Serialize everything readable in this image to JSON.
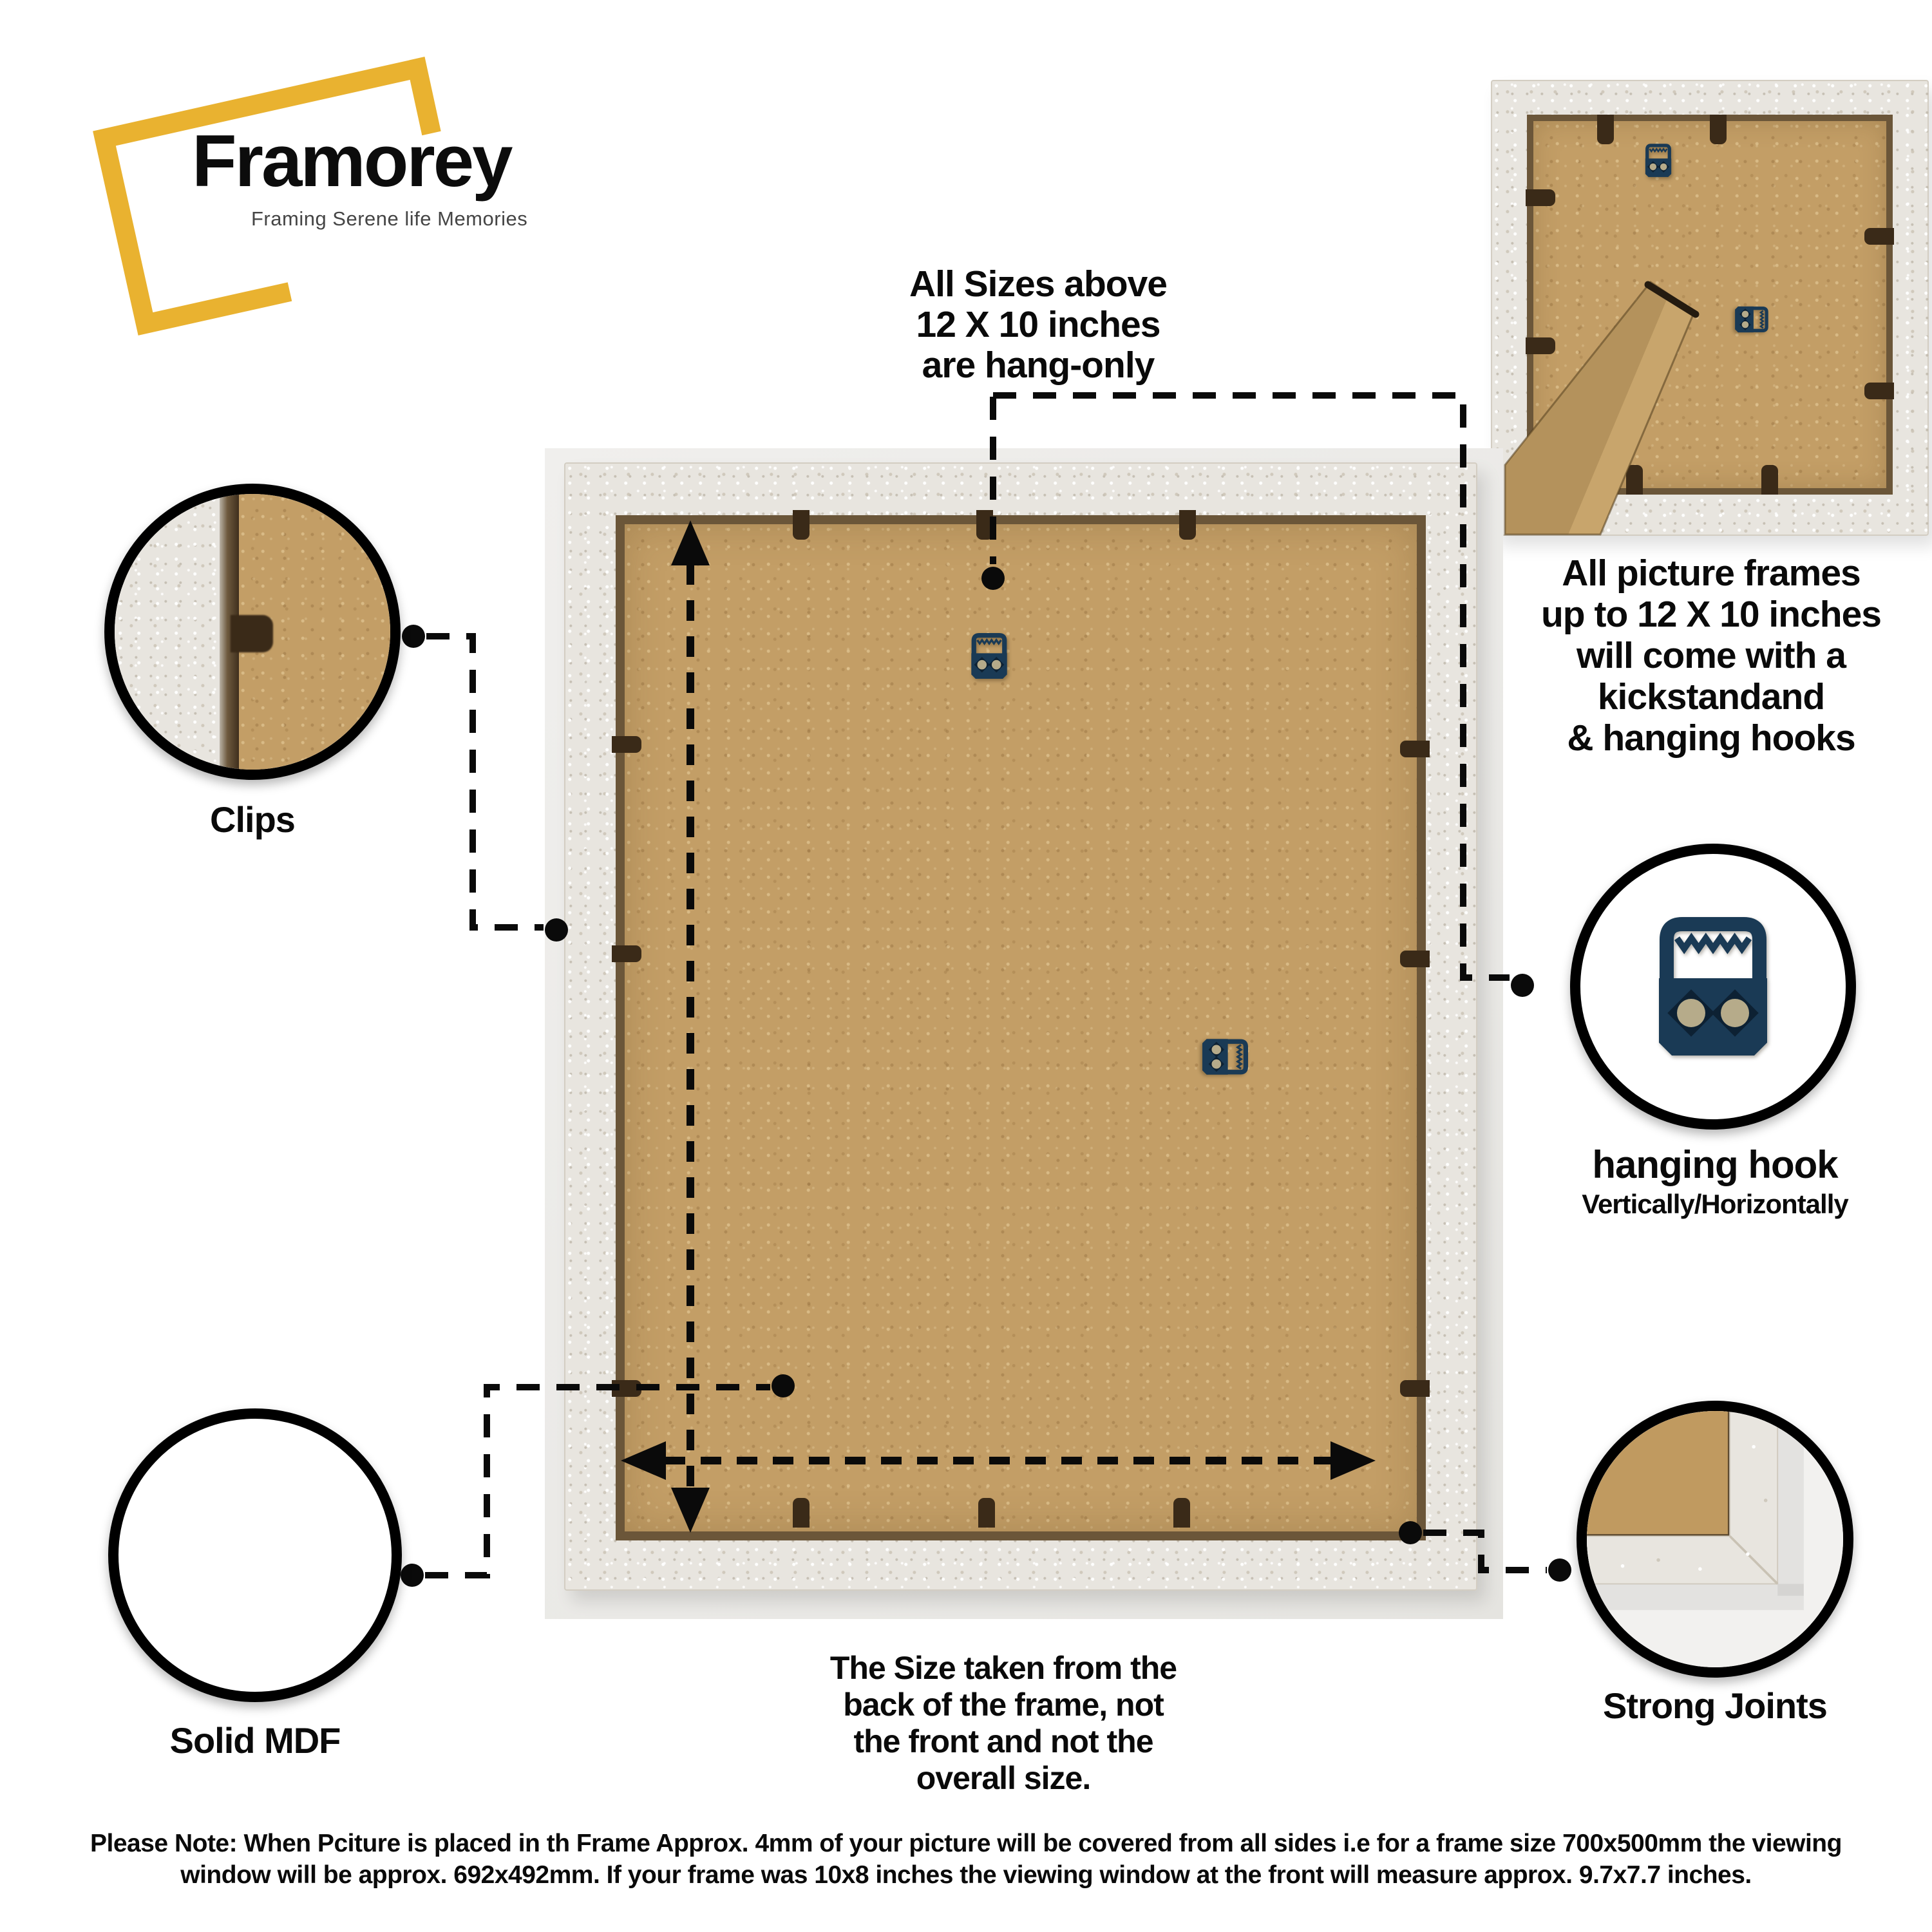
{
  "brand": {
    "name": "Framorey",
    "tagline": "Framing Serene life Memories"
  },
  "notes": {
    "hang_only": "All Sizes above\n12 X 10 inches\nare hang-only",
    "kickstand": "All picture frames\nup to 12 X 10 inches\nwill come with a\nkickstandand\n& hanging hooks",
    "size": "The Size taken from the\nback of the frame, not\nthe front and not the\noverall size.",
    "footer": "Please Note: When Pciture is placed in th Frame Approx. 4mm of your picture will be covered from all sides i.e for a frame size 700x500mm the viewing\nwindow will be approx. 692x492mm. If your frame was 10x8 inches the viewing window at the front will measure approx. 9.7x7.7 inches."
  },
  "callouts": {
    "clips": {
      "label": "Clips"
    },
    "hanging_hook": {
      "label": "hanging hook",
      "sublabel": "Vertically/Horizontally"
    },
    "solid_mdf": {
      "label": "Solid MDF"
    },
    "strong_joints": {
      "label": "Strong Joints"
    }
  },
  "icons": {
    "brand_frame": "tilted-gold-frame-outline",
    "hanging_hook": "sawtooth-picture-hanger",
    "kickstand": "mdf-kickstand-leg",
    "measure_vertical": "dashed-double-arrow-vertical",
    "measure_horizontal": "dashed-double-arrow-horizontal",
    "connector": "dashed-leader-line-with-dots"
  },
  "colors": {
    "accent_gold": "#E9B230",
    "mdf_tan": "#C39E66",
    "frame_white": "#E8E5DF",
    "hook_navy": "#1A3A55",
    "ink": "#0A0A0A"
  }
}
